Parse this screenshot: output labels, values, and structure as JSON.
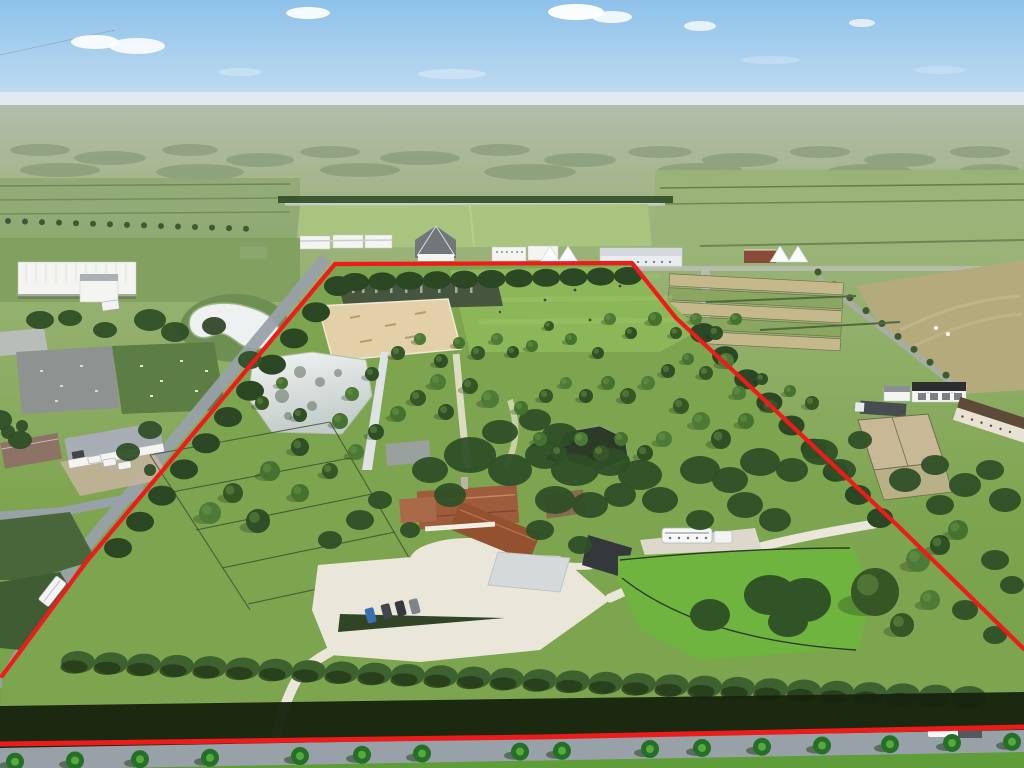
{
  "scene": {
    "description": "Aerial drone photograph of a large equestrian estate outlined with a red property boundary line",
    "type": "aerial-photograph",
    "visible_text": "none"
  },
  "colors": {
    "boundary_red": "#ee1b1b",
    "sky_top": "#8ec2ea",
    "sky_horizon": "#dce9f3",
    "haze": "#e6ebee",
    "land_far": "#b3bcab",
    "land_mid": "#93ad72",
    "lawn": "#7da44e",
    "lawn_bright": "#6fb43e",
    "polo_green": "#8cb758",
    "hedge": "#2c4723",
    "hedge_shadow": "#17230f",
    "tree_dark": "#2f4f26",
    "tree_mid": "#46722f",
    "sand_arena": "#e2d0a8",
    "gravel": "#eae6da",
    "water_silver": "#dde3e2",
    "water_dark": "#46553d",
    "pond_dark": "#2c3a28",
    "roof_terracotta": "#9e5c3c",
    "roof_gray": "#9aa0a4",
    "roof_dark": "#34383a",
    "roof_brown": "#5d4a38",
    "wall_white": "#f4f4f0",
    "road": "#98a1a8",
    "road_light": "#b9bdb4",
    "paddock_tan": "#c5b98c",
    "field_tan": "#b5aa7c"
  },
  "boundary": {
    "outline_points": "2,676 87,561 335,264 632,263 676,318 740,377 897,525 1024,649",
    "road_edge_points": "0,744 540,737 1024,727",
    "stroke_width": 4.2,
    "road_stroke_width": 5
  },
  "clouds": [
    [
      95,
      42,
      24,
      7,
      0.9
    ],
    [
      137,
      46,
      28,
      8,
      0.85
    ],
    [
      308,
      13,
      22,
      6,
      0.9
    ],
    [
      576,
      12,
      28,
      8,
      0.95
    ],
    [
      612,
      17,
      20,
      6,
      0.85
    ],
    [
      700,
      26,
      16,
      5,
      0.75
    ],
    [
      862,
      23,
      13,
      4,
      0.7
    ],
    [
      452,
      74,
      34,
      5,
      0.3
    ],
    [
      240,
      72,
      22,
      4,
      0.25
    ],
    [
      770,
      60,
      30,
      4,
      0.22
    ],
    [
      940,
      70,
      26,
      4,
      0.2
    ]
  ],
  "distant_blobs": [
    [
      40,
      150,
      30,
      6
    ],
    [
      110,
      158,
      36,
      7
    ],
    [
      190,
      150,
      28,
      6
    ],
    [
      260,
      160,
      34,
      7
    ],
    [
      330,
      152,
      30,
      6
    ],
    [
      420,
      158,
      40,
      7
    ],
    [
      500,
      150,
      30,
      6
    ],
    [
      580,
      160,
      36,
      7
    ],
    [
      660,
      152,
      32,
      6
    ],
    [
      740,
      160,
      38,
      7
    ],
    [
      820,
      152,
      30,
      6
    ],
    [
      900,
      160,
      36,
      7
    ],
    [
      980,
      152,
      30,
      6
    ],
    [
      60,
      170,
      40,
      7
    ],
    [
      200,
      172,
      44,
      8
    ],
    [
      360,
      170,
      40,
      7
    ],
    [
      530,
      172,
      46,
      8
    ],
    [
      700,
      170,
      42,
      7
    ],
    [
      870,
      172,
      44,
      8
    ],
    [
      990,
      170,
      30,
      6
    ]
  ],
  "topiary_trees": [
    [
      300,
      447,
      9
    ],
    [
      270,
      471,
      10
    ],
    [
      233,
      493,
      10
    ],
    [
      210,
      513,
      11
    ],
    [
      258,
      521,
      12
    ],
    [
      300,
      493,
      9
    ],
    [
      330,
      471,
      8
    ],
    [
      356,
      452,
      8
    ],
    [
      376,
      432,
      8
    ],
    [
      398,
      414,
      8
    ],
    [
      418,
      398,
      8
    ],
    [
      438,
      382,
      8
    ],
    [
      300,
      415,
      7
    ],
    [
      282,
      383,
      6
    ],
    [
      262,
      403,
      7
    ],
    [
      352,
      394,
      7
    ],
    [
      372,
      374,
      7
    ],
    [
      340,
      421,
      8
    ],
    [
      398,
      353,
      7
    ],
    [
      420,
      339,
      6
    ],
    [
      441,
      361,
      7
    ],
    [
      459,
      343,
      6
    ],
    [
      478,
      353,
      7
    ],
    [
      497,
      339,
      6
    ],
    [
      513,
      352,
      6
    ],
    [
      532,
      346,
      6
    ],
    [
      470,
      386,
      8
    ],
    [
      490,
      399,
      9
    ],
    [
      446,
      412,
      8
    ],
    [
      521,
      408,
      7
    ],
    [
      546,
      396,
      7
    ],
    [
      566,
      383,
      6
    ],
    [
      586,
      396,
      7
    ],
    [
      608,
      383,
      7
    ],
    [
      628,
      396,
      8
    ],
    [
      648,
      383,
      7
    ],
    [
      668,
      371,
      7
    ],
    [
      688,
      359,
      6
    ],
    [
      706,
      373,
      7
    ],
    [
      726,
      361,
      8
    ],
    [
      598,
      353,
      6
    ],
    [
      571,
      339,
      6
    ],
    [
      549,
      326,
      5
    ],
    [
      610,
      319,
      6
    ],
    [
      631,
      333,
      6
    ],
    [
      655,
      319,
      7
    ],
    [
      676,
      333,
      6
    ],
    [
      696,
      319,
      6
    ],
    [
      716,
      333,
      7
    ],
    [
      736,
      319,
      6
    ],
    [
      681,
      406,
      8
    ],
    [
      701,
      421,
      9
    ],
    [
      721,
      439,
      10
    ],
    [
      746,
      421,
      8
    ],
    [
      770,
      406,
      7
    ],
    [
      739,
      393,
      7
    ],
    [
      762,
      379,
      6
    ],
    [
      790,
      391,
      6
    ],
    [
      812,
      403,
      7
    ],
    [
      664,
      439,
      8
    ],
    [
      645,
      453,
      8
    ],
    [
      621,
      439,
      7
    ],
    [
      601,
      453,
      8
    ],
    [
      581,
      439,
      7
    ],
    [
      559,
      453,
      8
    ],
    [
      540,
      439,
      7
    ],
    [
      875,
      592,
      24
    ],
    [
      918,
      560,
      12
    ],
    [
      940,
      545,
      10
    ],
    [
      958,
      530,
      10
    ],
    [
      902,
      625,
      12
    ],
    [
      930,
      600,
      10
    ]
  ],
  "tree_clusters": [
    [
      470,
      455,
      26,
      18
    ],
    [
      510,
      470,
      22,
      16
    ],
    [
      545,
      455,
      20,
      14
    ],
    [
      575,
      470,
      24,
      16
    ],
    [
      610,
      462,
      20,
      14
    ],
    [
      640,
      475,
      22,
      15
    ],
    [
      500,
      432,
      18,
      12
    ],
    [
      535,
      420,
      16,
      11
    ],
    [
      560,
      435,
      18,
      12
    ],
    [
      430,
      470,
      18,
      13
    ],
    [
      450,
      495,
      16,
      12
    ],
    [
      555,
      500,
      20,
      14
    ],
    [
      590,
      505,
      18,
      13
    ],
    [
      620,
      495,
      16,
      12
    ],
    [
      660,
      500,
      18,
      13
    ],
    [
      700,
      470,
      20,
      14
    ],
    [
      730,
      480,
      18,
      13
    ],
    [
      760,
      462,
      20,
      14
    ],
    [
      792,
      470,
      16,
      12
    ],
    [
      820,
      452,
      18,
      13
    ],
    [
      840,
      470,
      16,
      11
    ],
    [
      745,
      505,
      18,
      13
    ],
    [
      775,
      520,
      16,
      12
    ],
    [
      700,
      520,
      14,
      10
    ],
    [
      540,
      530,
      14,
      10
    ],
    [
      580,
      545,
      12,
      9
    ],
    [
      380,
      500,
      12,
      9
    ],
    [
      360,
      520,
      14,
      10
    ],
    [
      330,
      540,
      12,
      9
    ],
    [
      410,
      530,
      10,
      8
    ],
    [
      905,
      480,
      16,
      12
    ],
    [
      935,
      465,
      14,
      10
    ],
    [
      965,
      485,
      16,
      12
    ],
    [
      990,
      470,
      14,
      10
    ],
    [
      1005,
      500,
      16,
      12
    ],
    [
      940,
      505,
      14,
      10
    ],
    [
      860,
      440,
      12,
      9
    ],
    [
      995,
      560,
      14,
      10
    ],
    [
      1012,
      585,
      12,
      9
    ],
    [
      965,
      610,
      13,
      10
    ],
    [
      995,
      635,
      12,
      9
    ],
    [
      150,
      320,
      16,
      11
    ],
    [
      175,
      332,
      14,
      10
    ],
    [
      250,
      360,
      12,
      9
    ],
    [
      150,
      430,
      12,
      9
    ],
    [
      128,
      452,
      12,
      9
    ],
    [
      40,
      320,
      14,
      9
    ],
    [
      70,
      318,
      12,
      8
    ],
    [
      105,
      330,
      12,
      8
    ],
    [
      0,
      420,
      12,
      10
    ],
    [
      20,
      440,
      12,
      9
    ],
    [
      8,
      432,
      7,
      7
    ],
    [
      22,
      426,
      6,
      6
    ],
    [
      150,
      470,
      6,
      6
    ]
  ],
  "hedge_bands": [
    {
      "x0": 118,
      "y0": 548,
      "x1": 338,
      "y1": 286,
      "n": 11,
      "rx": 14,
      "ry": 10
    },
    {
      "x0": 355,
      "y0": 282,
      "x1": 628,
      "y1": 276,
      "n": 11,
      "rx": 14,
      "ry": 9
    },
    {
      "x0": 703,
      "y0": 333,
      "x1": 880,
      "y1": 518,
      "n": 9,
      "rx": 13,
      "ry": 10
    }
  ],
  "bottom_hedge": {
    "x0": 78,
    "x1": 995,
    "step": 33,
    "y0": 662,
    "y1": 698,
    "rx": 17,
    "ry": 11
  },
  "mid_palm_row": {
    "x0": 8,
    "x1": 255,
    "step": 17,
    "y0": 221,
    "y1": 229,
    "r": 3
  },
  "diag_road_palms": {
    "x0": 818,
    "y0": 272,
    "x1": 962,
    "y1": 388,
    "n": 10,
    "r": 3.5
  },
  "left_fences": [
    [
      150,
      455,
      330,
      422
    ],
    [
      172,
      492,
      350,
      458
    ],
    [
      196,
      530,
      372,
      494
    ],
    [
      222,
      568,
      395,
      532
    ],
    [
      248,
      604,
      415,
      568
    ],
    [
      150,
      455,
      250,
      610
    ],
    [
      330,
      422,
      415,
      568
    ]
  ],
  "pond_reflections": [
    [
      300,
      372,
      6
    ],
    [
      320,
      382,
      5
    ],
    [
      282,
      396,
      7
    ],
    [
      338,
      373,
      4
    ],
    [
      312,
      406,
      5
    ],
    [
      288,
      416,
      4
    ]
  ],
  "long_pond_streaks": [
    352,
    362,
    375,
    390,
    405,
    420,
    438,
    455,
    470
  ],
  "palm_row_bottom": [
    15,
    75,
    140,
    210,
    300,
    362,
    422,
    520,
    562,
    650,
    702,
    762,
    822,
    890,
    952,
    1012
  ],
  "vehicles": {
    "parking_cars": [
      [
        366,
        608,
        "#3a6fb5"
      ],
      [
        382,
        604,
        "#42464a"
      ],
      [
        396,
        601,
        "#35383c"
      ],
      [
        410,
        599,
        "#7e8488"
      ]
    ],
    "neighbor_cars": [
      [
        88,
        456
      ],
      [
        103,
        459
      ],
      [
        118,
        462
      ]
    ],
    "horse_bus": {
      "x": 662,
      "y": 528,
      "w": 50,
      "h": 15
    },
    "support_truck": {
      "x": 714,
      "y": 531,
      "w": 18,
      "h": 12
    },
    "road_truck": {
      "x": 928,
      "y": 727,
      "w": 30,
      "h": 10
    },
    "left_road_rv": {
      "x": 46,
      "y": 576,
      "w": 13,
      "h": 30
    }
  }
}
